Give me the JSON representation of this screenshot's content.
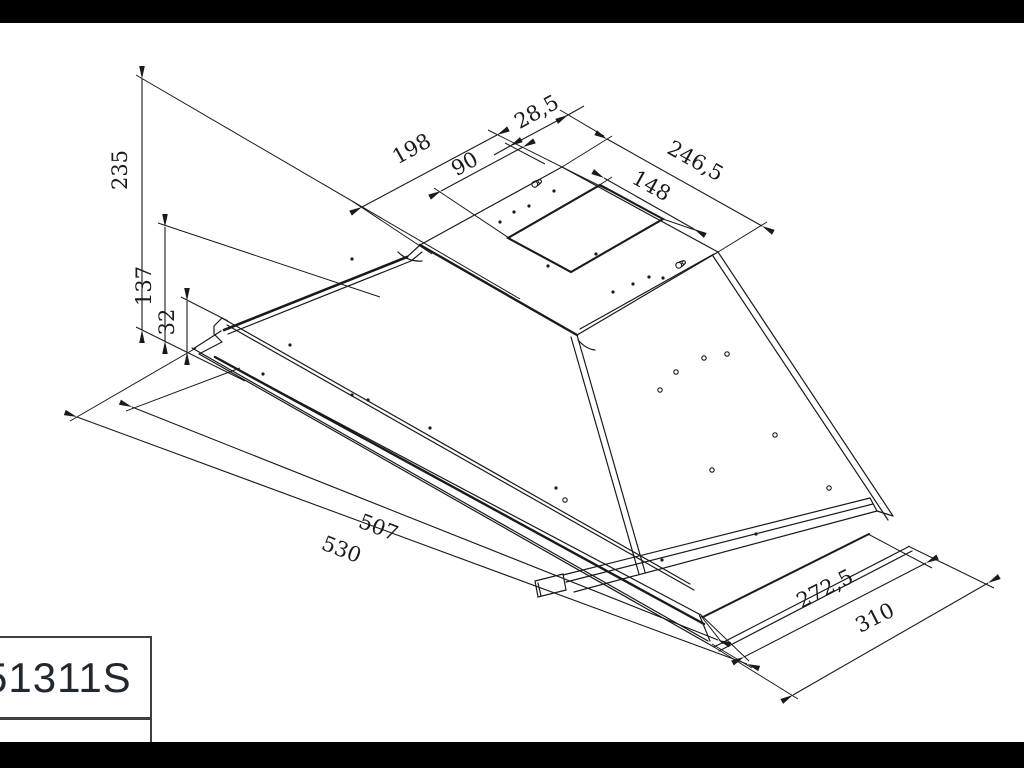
{
  "drawing": {
    "type": "isometric technical drawing of built-in cooker hood chassis",
    "dims": {
      "total_height": "235",
      "mid_height": "137",
      "front_lip_height": "32",
      "top_rear_offset": "198",
      "cutout_width": "90",
      "cutout_front_offset": "28,5",
      "top_panel_length": "246,5",
      "cutout_length": "148",
      "inner_length": "507",
      "outer_length": "530",
      "inner_width": "272,5",
      "outer_width": "310"
    },
    "title_block": {
      "model": "51311S"
    },
    "icons": {
      "mounting_slot": "keyhole-slot-icon"
    },
    "colors": {
      "line": "#1a1a1a",
      "background": "#ffffff",
      "bar": "#000000",
      "title_text": "#23272f"
    }
  }
}
